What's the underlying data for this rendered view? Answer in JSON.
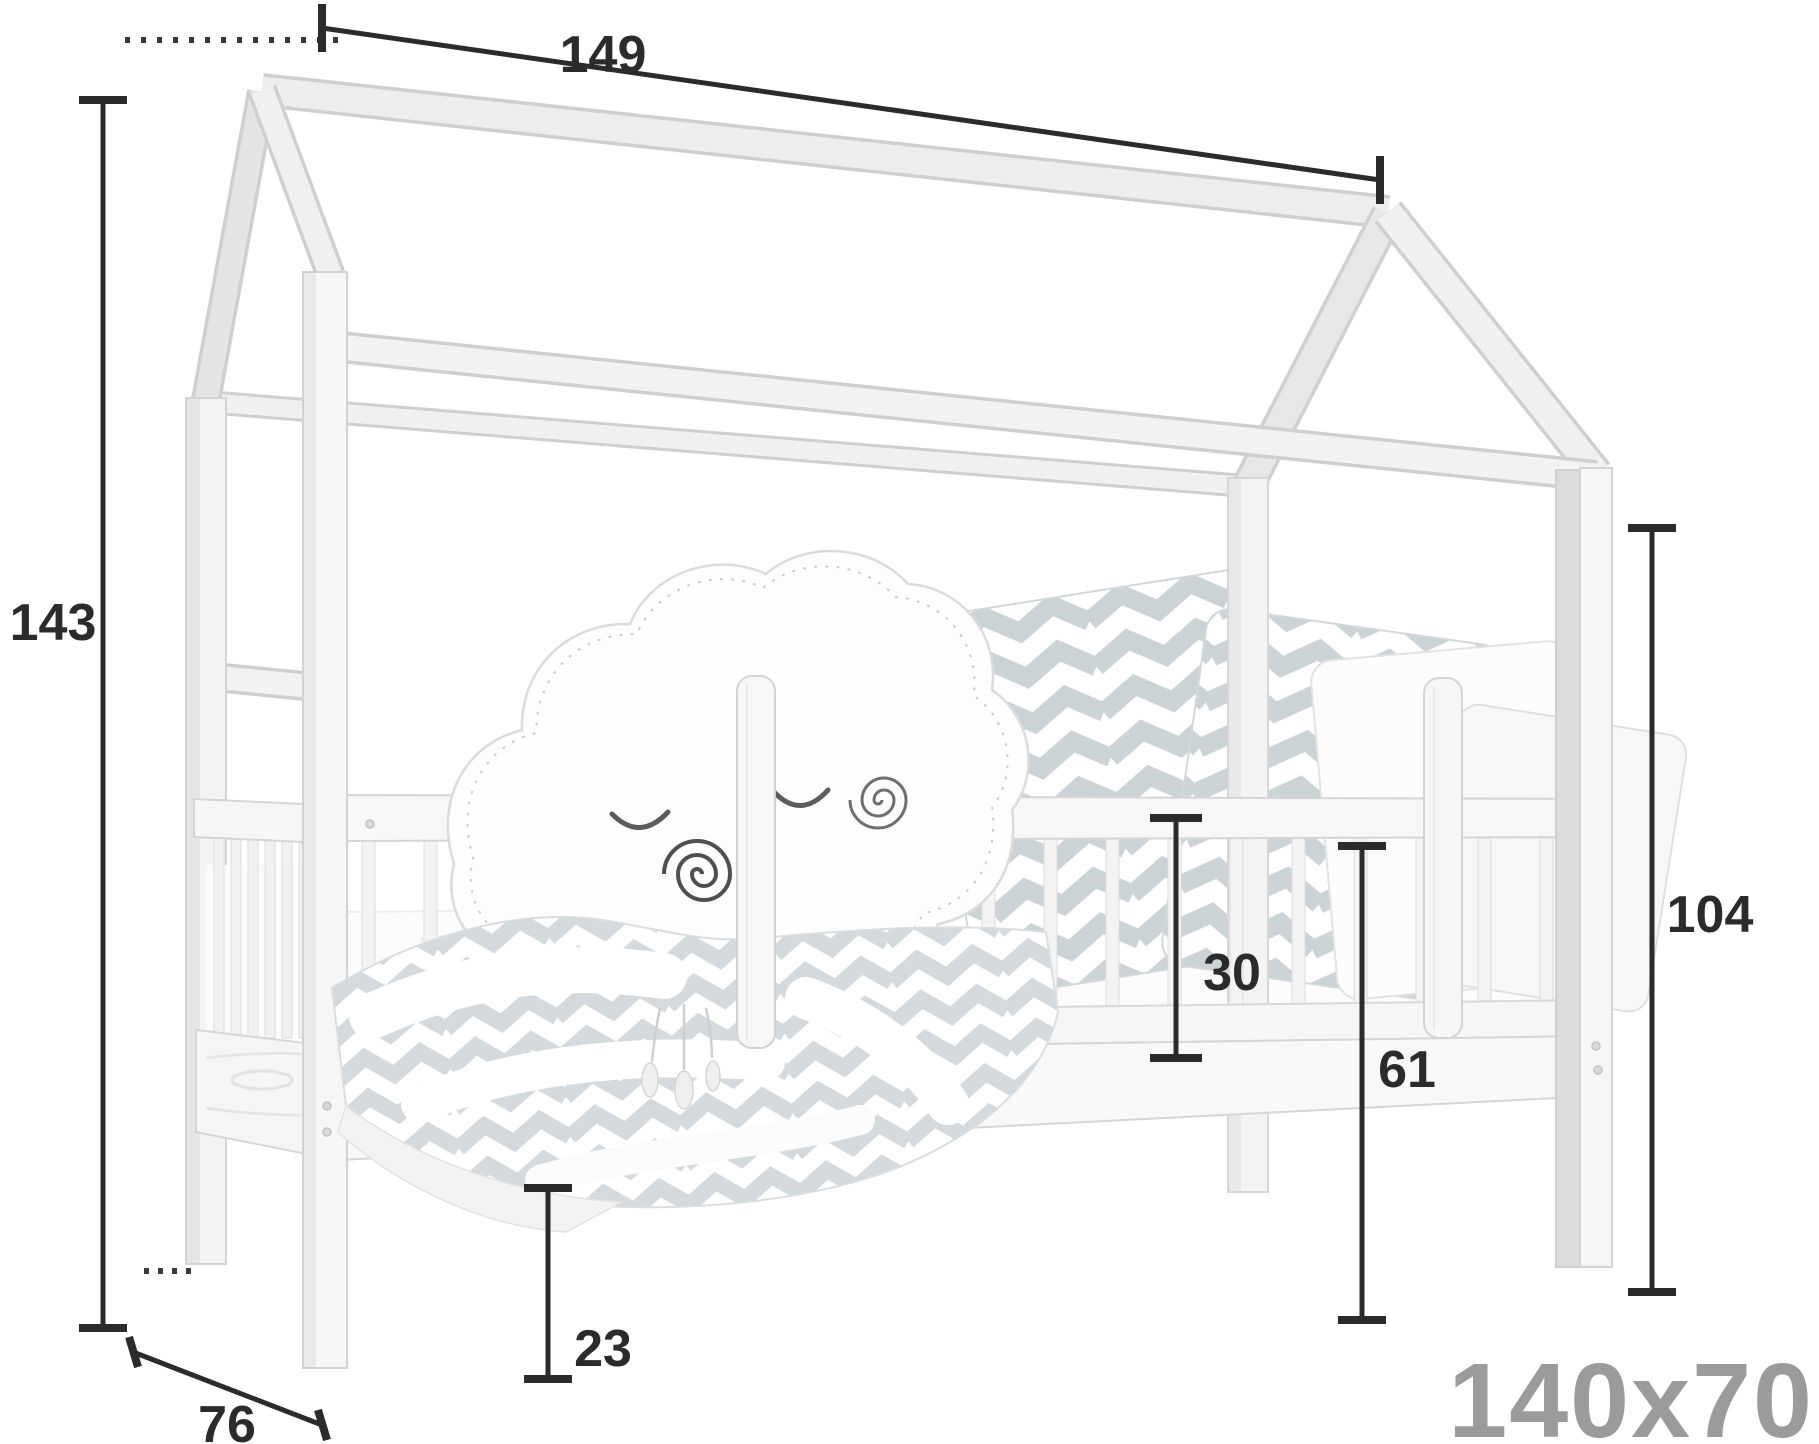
{
  "figure": {
    "kind": "furniture-dimension-diagram",
    "subject": "children house-frame bed with guard rails, cloud pillow and chevron bedding",
    "size_label": "140x70",
    "dimensions": {
      "ridge_length": "149",
      "overall_height": "143",
      "post_height": "104",
      "rail_height": "30",
      "side_height": "61",
      "clearance": "23",
      "depth": "76"
    },
    "colors": {
      "background": "#ffffff",
      "annotation": "#2b2b2b",
      "size_label": "#9b9b9b",
      "wood_light": "#f4f4f4",
      "wood_edge": "#d2d2d2",
      "textile_chevron": "#ccd3d7"
    }
  }
}
